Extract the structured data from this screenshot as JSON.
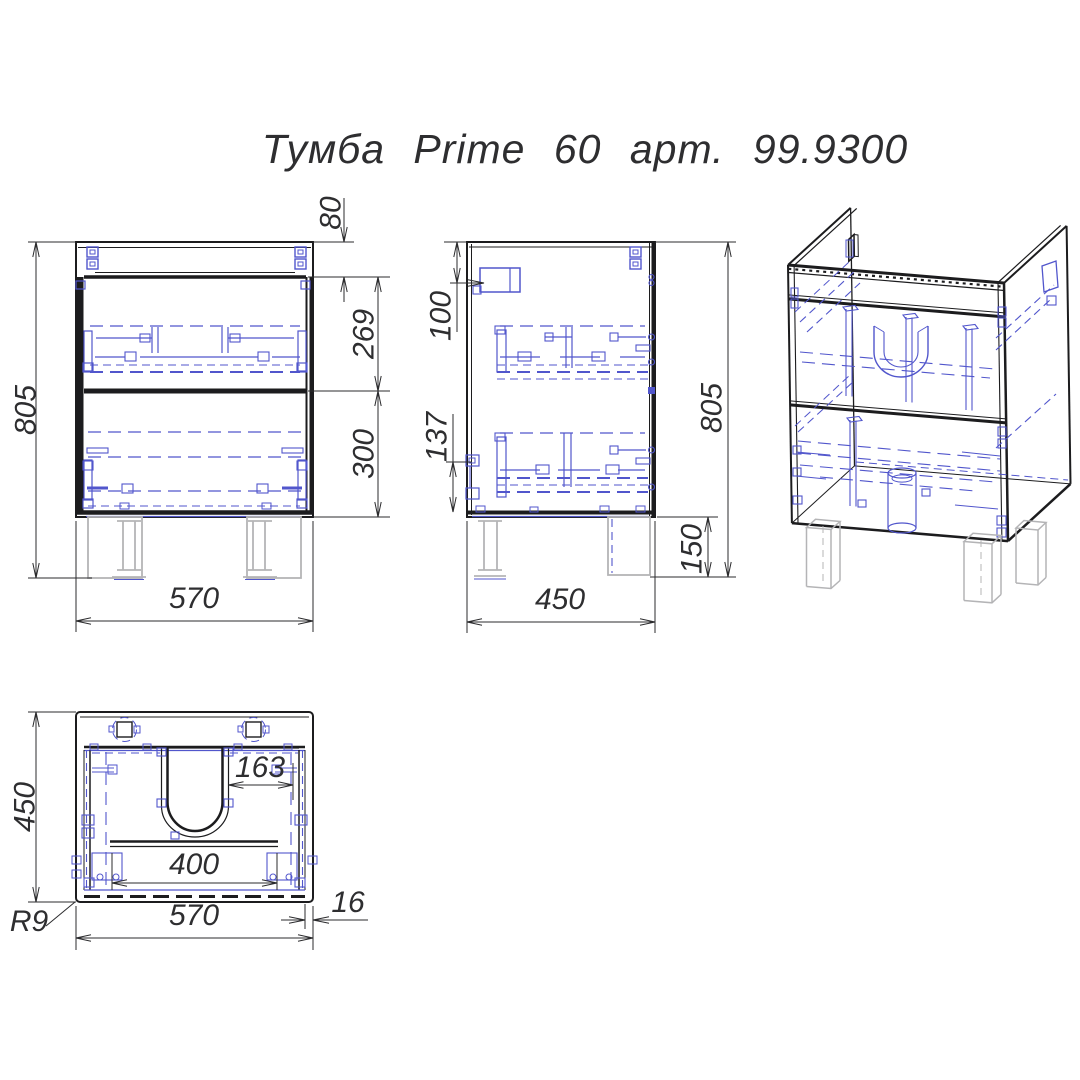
{
  "title": "Тумба Prime 60 арт. 99.9300",
  "front_view": {
    "overall_height": "805",
    "top_gap": "80",
    "upper_drawer_height": "269",
    "lower_drawer_height": "300",
    "width": "570"
  },
  "side_view": {
    "hanger_offset": "100",
    "slide_offset": "137",
    "overall_height": "805",
    "leg_height": "150",
    "depth": "450"
  },
  "top_view": {
    "depth": "450",
    "siphon_offset": "163",
    "brace_length": "400",
    "width": "570",
    "panel_thickness": "16",
    "corner_radius": "R9"
  },
  "colors": {
    "outline": "#1c1c1e",
    "hidden_detail_blue": "#5156cc",
    "legs_grey": "#b4b4b6",
    "dimension": "#2b2b2d",
    "background": "#ffffff"
  }
}
